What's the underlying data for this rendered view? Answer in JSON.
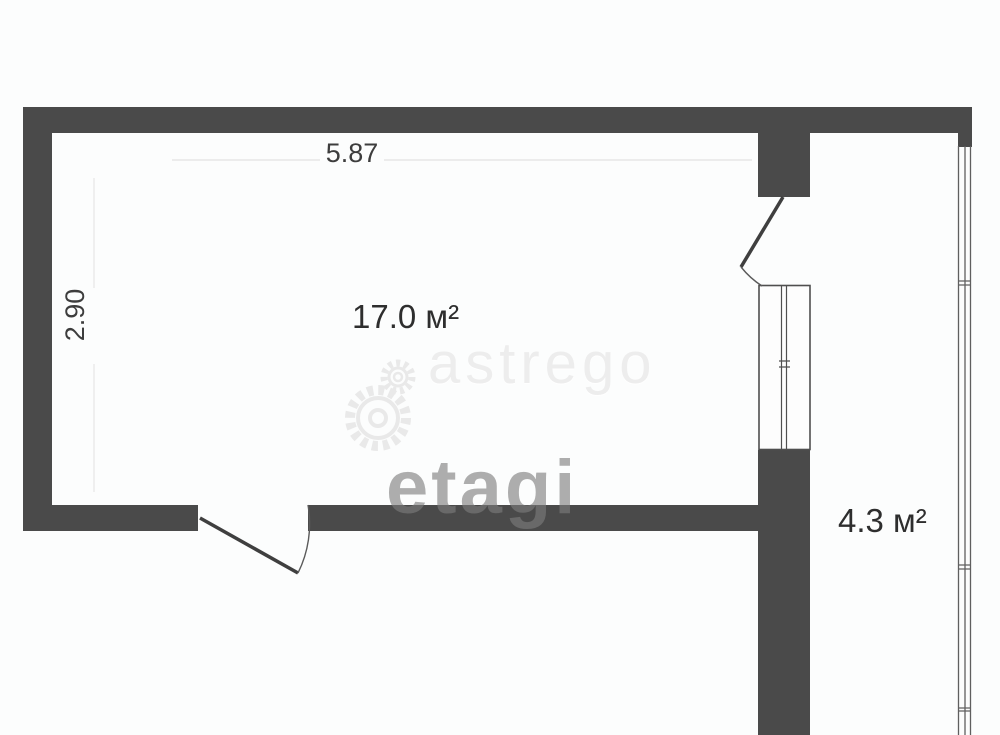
{
  "document": {
    "type": "apartment floor plan"
  },
  "colors": {
    "wall": "#4a4a4a",
    "background": "#fcfdfd",
    "dimension_text": "#3d3d3d",
    "area_text": "#2e2e2e",
    "watermark_light": "#ededed",
    "watermark_gray": "#7d7d7d"
  },
  "dimensions": {
    "top_width_m": "5.87",
    "left_height_m": "2.90"
  },
  "rooms": [
    {
      "name": "main-room",
      "area_label": "17.0 м²"
    },
    {
      "name": "balcony",
      "area_label": "4.3 м²"
    }
  ],
  "watermarks": {
    "brand_center": "astrego",
    "brand_lower": "etagi",
    "icon": "gears-icon"
  }
}
